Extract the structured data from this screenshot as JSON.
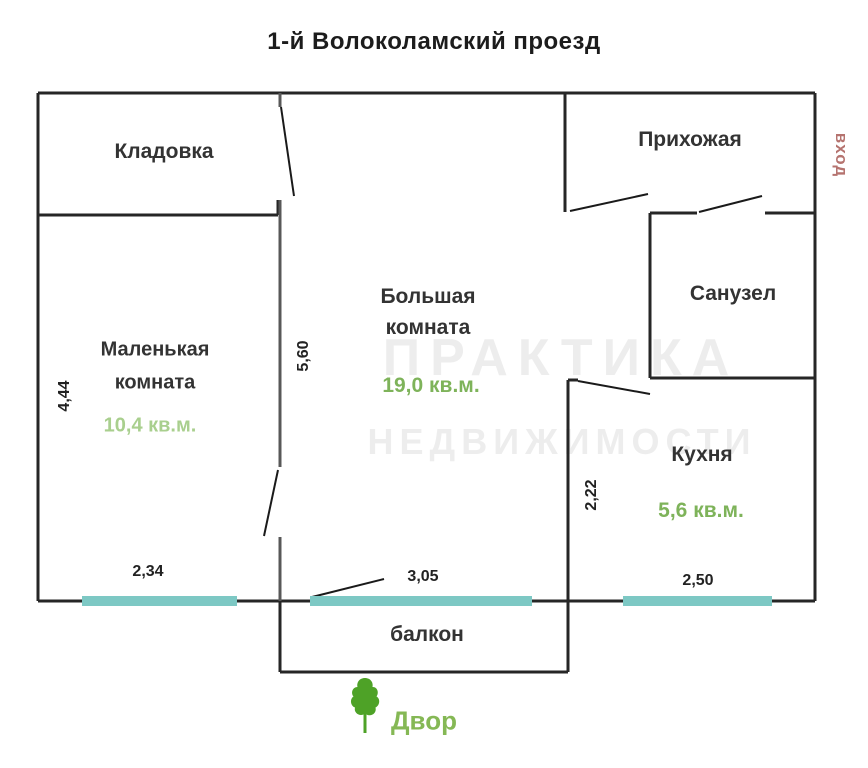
{
  "title": "1-й Волоколамский проезд",
  "entrance": {
    "label": "вход"
  },
  "rooms": {
    "storage": {
      "name": "Кладовка"
    },
    "hallway": {
      "name": "Прихожая"
    },
    "bathroom": {
      "name": "Санузел"
    },
    "big_room": {
      "name_line1": "Большая",
      "name_line2": "комната",
      "area": "19,0 кв.м."
    },
    "small_room": {
      "name_line1": "Маленькая",
      "name_line2": "комната",
      "area": "10,4 кв.м."
    },
    "kitchen": {
      "name": "Кухня",
      "area": "5,6 кв.м."
    },
    "balcony": {
      "name": "балкон"
    }
  },
  "dimensions": {
    "small_room_height": "4,44",
    "big_room_height": "5,60",
    "kitchen_height": "2,22",
    "small_room_width": "2,34",
    "balcony_width": "3,05",
    "kitchen_width": "2,50"
  },
  "yard": {
    "label": "Двор",
    "icon": "tree-icon"
  },
  "watermark": {
    "line1": "ПРАКТИКА",
    "line2": "НЕДВИЖИМОСТИ"
  },
  "colors": {
    "area_green": "#7eb35a",
    "area_green_light": "#a9cf8e",
    "window_teal": "#7dc8c4",
    "entrance_red": "#b5736f",
    "tree_green": "#4ea227",
    "yard_green": "#85b855",
    "wall_dark": "#262626",
    "wall_gray": "#585858"
  }
}
